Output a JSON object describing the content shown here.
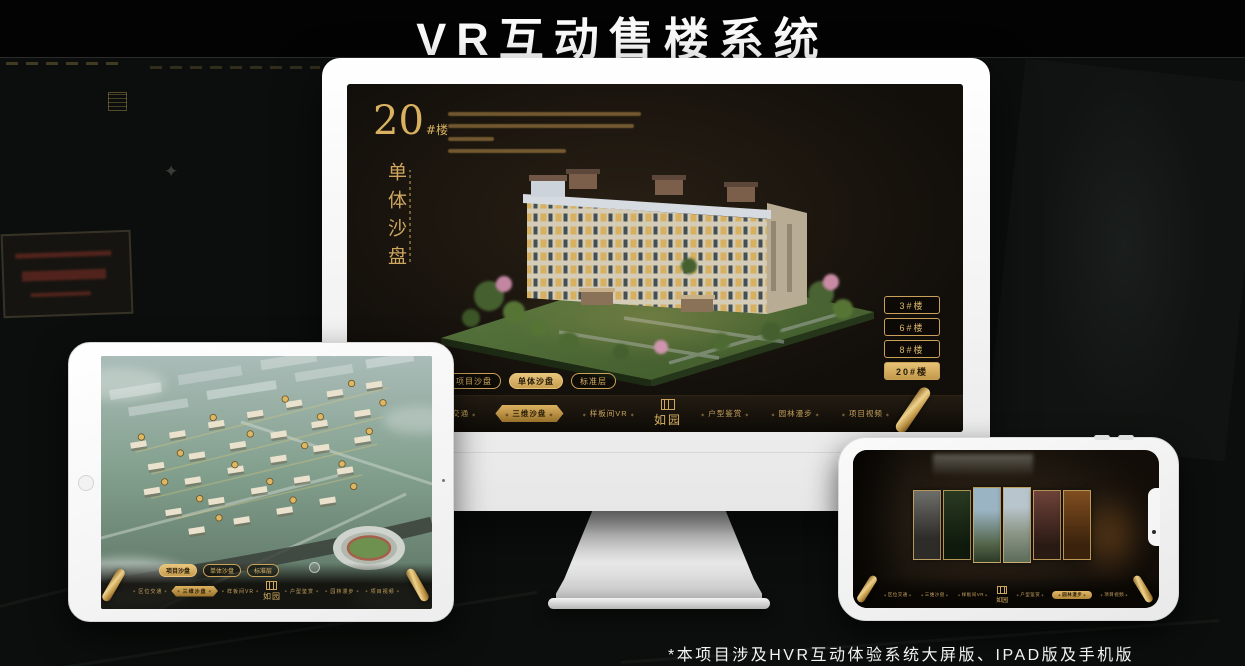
{
  "page": {
    "title": "VR互动售楼系统",
    "footnote": "*本项目涉及HVR互动体验系统大屏版、IPAD版及手机版"
  },
  "brand": {
    "logo": "如园"
  },
  "colors": {
    "gold": "#cfa65e",
    "gold_bright": "#e8c47c",
    "screen_dark": "#18130e",
    "page_bg": "#0b0e0c"
  },
  "monitor": {
    "screen_title": {
      "number": "20",
      "suffix": "#楼",
      "subtitle": "单体沙盘"
    },
    "sub_tabs": [
      {
        "label": "项目沙盘"
      },
      {
        "label": "单体沙盘"
      },
      {
        "label": "标准层"
      }
    ],
    "active_sub_tab": "单体沙盘",
    "building_buttons": [
      {
        "label": "3#楼"
      },
      {
        "label": "6#楼"
      },
      {
        "label": "8#楼"
      },
      {
        "label": "20#楼"
      }
    ],
    "active_building": "20#楼",
    "nav_items": [
      {
        "label": "区位交通"
      },
      {
        "label": "三维沙盘"
      },
      {
        "label": "样板间VR"
      },
      {
        "label": "户型鉴赏"
      },
      {
        "label": "园林漫步"
      },
      {
        "label": "项目视频"
      }
    ],
    "active_nav": "三维沙盘"
  },
  "ipad": {
    "sub_tabs": [
      {
        "label": "项目沙盘"
      },
      {
        "label": "单体沙盘"
      },
      {
        "label": "标准层"
      }
    ],
    "active_sub_tab": "项目沙盘",
    "nav_items": [
      {
        "label": "区位交通"
      },
      {
        "label": "三维沙盘"
      },
      {
        "label": "样板间VR"
      },
      {
        "label": "户型鉴赏"
      },
      {
        "label": "园林漫步"
      },
      {
        "label": "项目视频"
      }
    ],
    "active_nav": "三维沙盘"
  },
  "phone": {
    "nav_items": [
      {
        "label": "区位交通"
      },
      {
        "label": "三维沙盘"
      },
      {
        "label": "样板间VR"
      },
      {
        "label": "户型鉴赏"
      },
      {
        "label": "园林漫步"
      },
      {
        "label": "项目视频"
      }
    ],
    "active_nav": "园林漫步",
    "gallery_panel_count": "6"
  }
}
